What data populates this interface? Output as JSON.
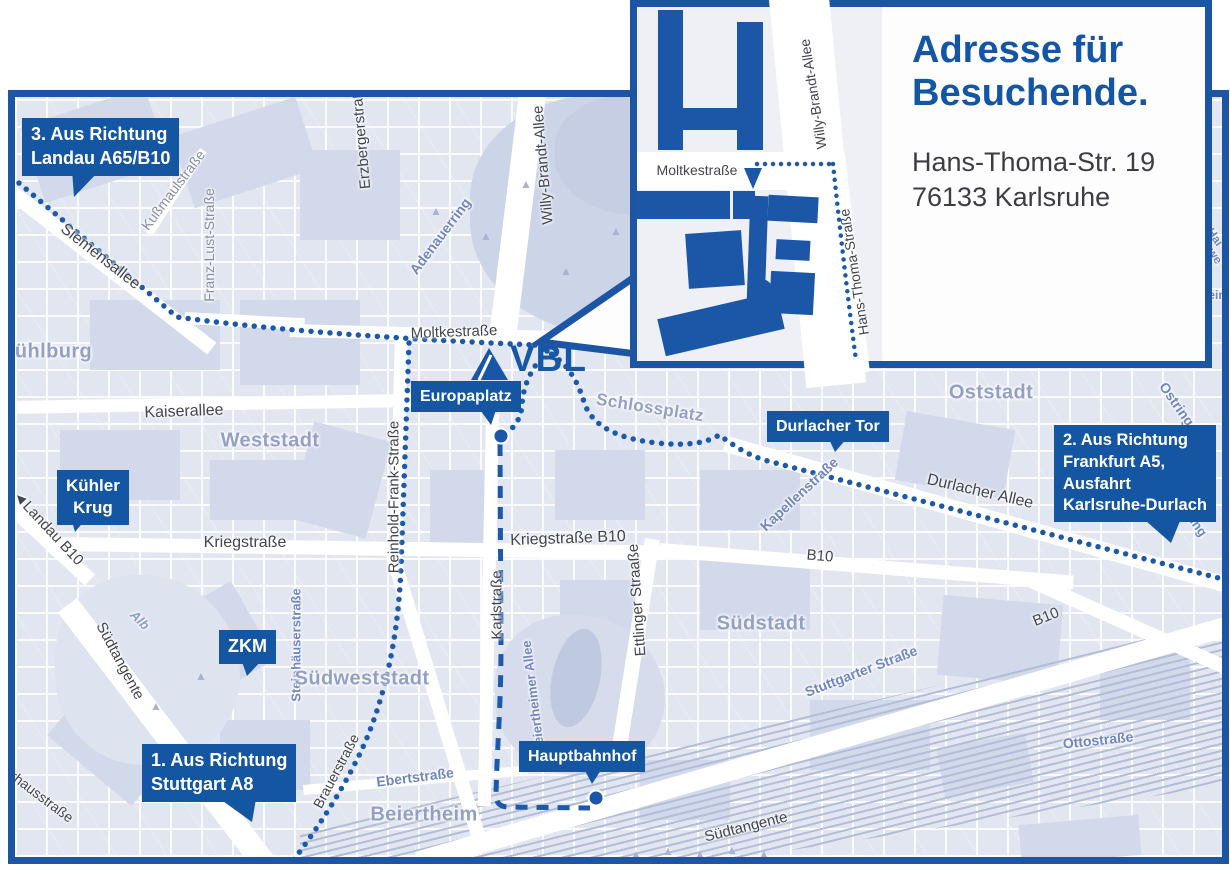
{
  "colors": {
    "accent": "#1556a2",
    "route_blue": "#1d59a9",
    "map_border": "#1b55a3",
    "area_label": "#93a0c4"
  },
  "logo": {
    "text": "VBL"
  },
  "inset": {
    "title": "Adresse für Besuchende.",
    "address_line1": "Hans-Thoma-Str. 19",
    "address_line2": "76133 Karlsruhe",
    "street_labels": [
      {
        "t": "Moltkestraße",
        "x": 697,
        "y": 170,
        "r": 0,
        "s": 14
      },
      {
        "t": "Willy-Brandt-Allee",
        "x": 813,
        "y": 94,
        "r": -99,
        "s": 14
      },
      {
        "t": "Hans-Thoma-Straße",
        "x": 854,
        "y": 272,
        "r": -99,
        "s": 14
      }
    ]
  },
  "callouts": [
    {
      "id": "route-3",
      "x": 22,
      "y": 118,
      "fs": 18,
      "align": "left",
      "lines": [
        "3. Aus Richtung",
        "Landau A65/B10"
      ]
    },
    {
      "id": "kuehler-krug",
      "x": 57,
      "y": 470,
      "fs": 17,
      "align": "center",
      "lines": [
        "Kühler",
        "Krug"
      ]
    },
    {
      "id": "zkm",
      "x": 219,
      "y": 630,
      "fs": 18,
      "align": "center",
      "lines": [
        "ZKM"
      ]
    },
    {
      "id": "route-1",
      "x": 142,
      "y": 744,
      "fs": 18,
      "align": "left",
      "lines": [
        "1. Aus Richtung",
        "Stuttgart A8"
      ]
    },
    {
      "id": "europaplatz",
      "x": 411,
      "y": 381,
      "fs": 16,
      "align": "left",
      "lines": [
        "Europaplatz"
      ]
    },
    {
      "id": "durlacher-tor",
      "x": 767,
      "y": 411,
      "fs": 16,
      "align": "left",
      "lines": [
        "Durlacher Tor"
      ]
    },
    {
      "id": "route-2",
      "x": 1054,
      "y": 425,
      "fs": 16.5,
      "align": "left",
      "lines": [
        "2. Aus Richtung",
        "Frankfurt A5,",
        "Ausfahrt",
        "Karlsruhe-Durlach"
      ]
    },
    {
      "id": "hauptbahnhof",
      "x": 519,
      "y": 741,
      "fs": 16,
      "align": "left",
      "lines": [
        "Hauptbahnhof"
      ]
    }
  ],
  "map": {
    "street_labels": [
      {
        "t": "Siemensallee",
        "x": 100,
        "y": 257,
        "r": 38,
        "c": "dark",
        "s": 16
      },
      {
        "t": "Kußmaulstraße",
        "x": 173,
        "y": 190,
        "r": -53,
        "c": "gray",
        "s": 14
      },
      {
        "t": "Franz-Lust-Straße",
        "x": 209,
        "y": 245,
        "r": -90,
        "c": "gray",
        "s": 14
      },
      {
        "t": "Erzbergerstraße",
        "x": 361,
        "y": 135,
        "r": -95,
        "c": "dark",
        "s": 15
      },
      {
        "t": "Willy-Brandt-Allee",
        "x": 543,
        "y": 165,
        "r": -95,
        "c": "dark",
        "s": 15
      },
      {
        "t": "Adenauerring",
        "x": 440,
        "y": 236,
        "r": -53,
        "c": "blue",
        "s": 14
      },
      {
        "t": "Moltkestraße",
        "x": 454,
        "y": 332,
        "r": -2,
        "c": "dark",
        "s": 15
      },
      {
        "t": "Kaiserallee",
        "x": 184,
        "y": 412,
        "r": -2,
        "c": "dark",
        "s": 16
      },
      {
        "t": "Reinhold-Frank-Straße",
        "x": 394,
        "y": 497,
        "r": -90,
        "c": "dark",
        "s": 15
      },
      {
        "t": "Kriegstraße",
        "x": 245,
        "y": 543,
        "r": 0,
        "c": "dark",
        "s": 16
      },
      {
        "t": "Kriegstraße B10",
        "x": 568,
        "y": 539,
        "r": -2,
        "c": "dark",
        "s": 16
      },
      {
        "t": "Karlstraße",
        "x": 497,
        "y": 605,
        "r": -90,
        "c": "dark",
        "s": 15
      },
      {
        "t": "Ettlinger Straaße",
        "x": 637,
        "y": 600,
        "r": -94,
        "c": "dark",
        "s": 15
      },
      {
        "t": "Kapellenstraße",
        "x": 799,
        "y": 494,
        "r": -43,
        "c": "blue",
        "s": 14
      },
      {
        "t": "Durlacher Allee",
        "x": 980,
        "y": 492,
        "r": 13,
        "c": "dark",
        "s": 16
      },
      {
        "t": "B10",
        "x": 820,
        "y": 556,
        "r": 5,
        "c": "dark",
        "s": 15
      },
      {
        "t": "B10",
        "x": 1046,
        "y": 617,
        "r": -22,
        "c": "dark",
        "s": 15
      },
      {
        "t": "Ostring",
        "x": 1177,
        "y": 404,
        "r": 55,
        "c": "blue",
        "s": 14
      },
      {
        "t": "Ostring",
        "x": 1191,
        "y": 516,
        "r": 55,
        "c": "blue",
        "s": 13
      },
      {
        "t": "Stuttgarter Straße",
        "x": 861,
        "y": 671,
        "r": -21,
        "c": "blue",
        "s": 14
      },
      {
        "t": "Ottostraße",
        "x": 1098,
        "y": 740,
        "r": -6,
        "c": "blue",
        "s": 14
      },
      {
        "t": "Südtangente",
        "x": 120,
        "y": 661,
        "r": 62,
        "c": "dark",
        "s": 15
      },
      {
        "t": "Südtangente",
        "x": 746,
        "y": 827,
        "r": -14,
        "c": "dark",
        "s": 15
      },
      {
        "t": "Alb",
        "x": 140,
        "y": 620,
        "r": 45,
        "c": "water",
        "s": 13
      },
      {
        "t": "Steinhäuserstraße",
        "x": 296,
        "y": 645,
        "r": -90,
        "c": "blue",
        "s": 13
      },
      {
        "t": "Brauerstraße",
        "x": 336,
        "y": 771,
        "r": -62,
        "c": "dark",
        "s": 14
      },
      {
        "t": "Ebertstraße",
        "x": 415,
        "y": 777,
        "r": -7,
        "c": "blue",
        "s": 14
      },
      {
        "t": "Beiertheimer Allee",
        "x": 533,
        "y": 697,
        "r": -97,
        "c": "blue",
        "s": 13
      },
      {
        "t": "Pulverhausstraße",
        "x": 28,
        "y": 786,
        "r": 37,
        "c": "dark",
        "s": 14
      },
      {
        "t": "◄Landau B10",
        "x": 48,
        "y": 528,
        "r": 47,
        "c": "dark",
        "s": 15
      },
      {
        "t": "Hai",
        "x": 1215,
        "y": 237,
        "r": 55,
        "c": "frag",
        "s": 12
      },
      {
        "t": "we",
        "x": 1215,
        "y": 256,
        "r": 55,
        "c": "frag",
        "s": 12
      },
      {
        "t": "ein",
        "x": 1217,
        "y": 295,
        "r": 0,
        "c": "frag",
        "s": 12
      }
    ],
    "area_labels": [
      {
        "t": "Mühlburg",
        "x": 45,
        "y": 352,
        "r": 0,
        "c": "area",
        "s": 20
      },
      {
        "t": "Weststadt",
        "x": 270,
        "y": 441,
        "r": 0,
        "c": "area",
        "s": 20
      },
      {
        "t": "Südweststadt",
        "x": 362,
        "y": 679,
        "r": 0,
        "c": "area",
        "s": 20
      },
      {
        "t": "Südstadt",
        "x": 761,
        "y": 624,
        "r": 0,
        "c": "area",
        "s": 20
      },
      {
        "t": "Oststadt",
        "x": 991,
        "y": 393,
        "r": 0,
        "c": "area",
        "s": 20
      },
      {
        "t": "Beiertheim",
        "x": 424,
        "y": 815,
        "r": 0,
        "c": "area",
        "s": 20
      },
      {
        "t": "Schlossplatz",
        "x": 650,
        "y": 408,
        "r": 9,
        "c": "area",
        "s": 17
      }
    ]
  }
}
